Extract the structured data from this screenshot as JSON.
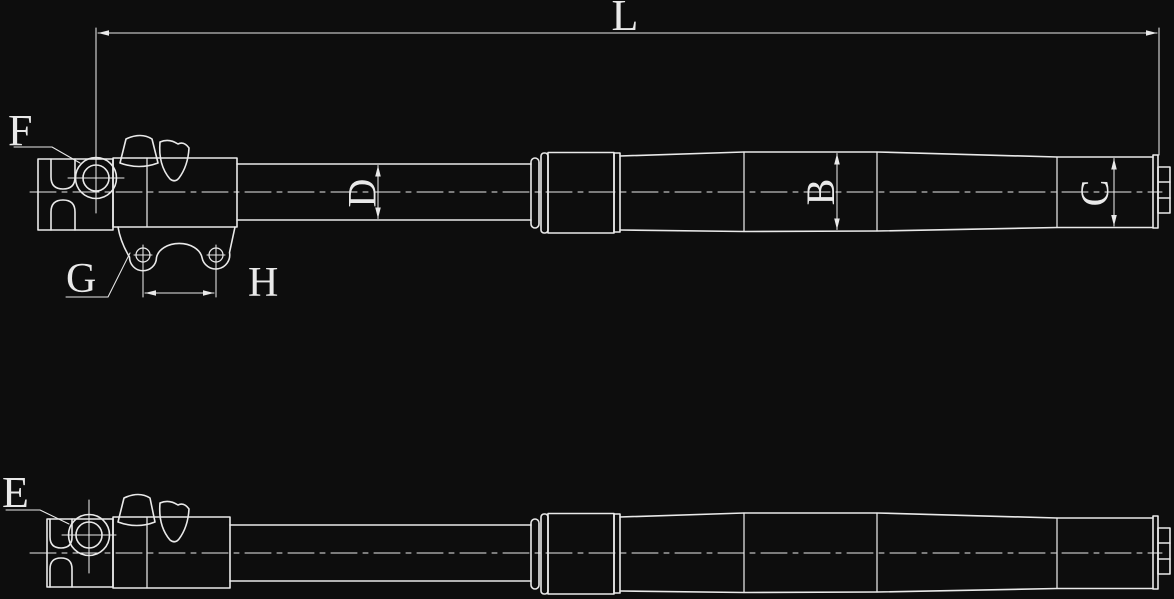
{
  "colors": {
    "background": "#0d0d0d",
    "line": "#e9e9e9"
  },
  "top_view": {
    "dim_overall": "L",
    "dim_inner_tube": "D",
    "dim_outer_tube": "B",
    "dim_end": "C",
    "callout_axle": "F",
    "callout_bracket_hole": "G",
    "dim_hole_spacing": "H"
  },
  "bottom_view": {
    "callout": "E"
  }
}
